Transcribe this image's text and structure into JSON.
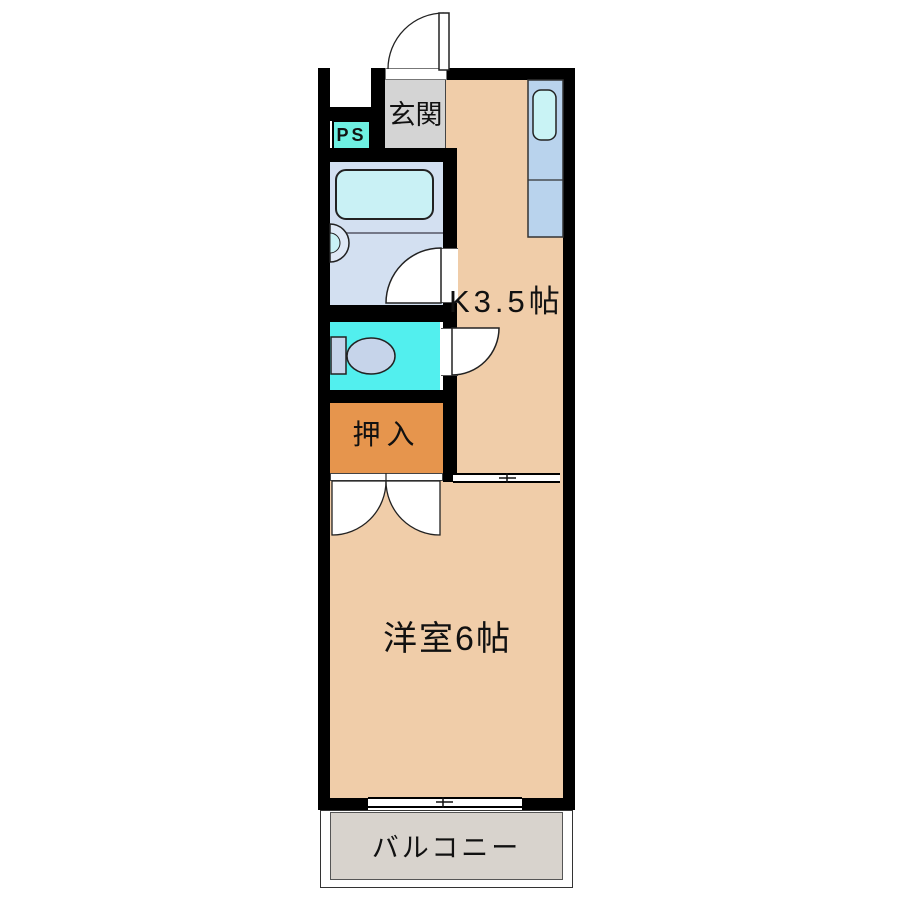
{
  "floorplan": {
    "labels": {
      "entrance": "玄関",
      "pipe_space": "PS",
      "kitchen": "K3.5帖",
      "closet": "押入",
      "western_room": "洋室6帖",
      "balcony": "バルコニー"
    },
    "fixtures": [
      "entrance-door",
      "bathtub",
      "wash-basin",
      "toilet",
      "kitchen-sink-counter",
      "bathroom-door",
      "toilet-door",
      "closet-double-doors",
      "sliding-partition",
      "balcony-sliding-window"
    ],
    "colors": {
      "wall": "#000000",
      "floor_room": "#f0cda9",
      "floor_entrance": "#d4d4d4",
      "floor_balcony": "#d8d3cd",
      "closet": "#e6954d",
      "toilet_room": "#52efee",
      "pipe_space": "#6ef0e2",
      "bathroom": "#d3e0f1",
      "bathtub": "#c9f1f5",
      "kitchen_unit": "#b9d3ed",
      "kitchen_sink": "#c9f3f5",
      "toilet_fixture": "#c6d4ea",
      "outline": "#1c1c1c"
    }
  }
}
